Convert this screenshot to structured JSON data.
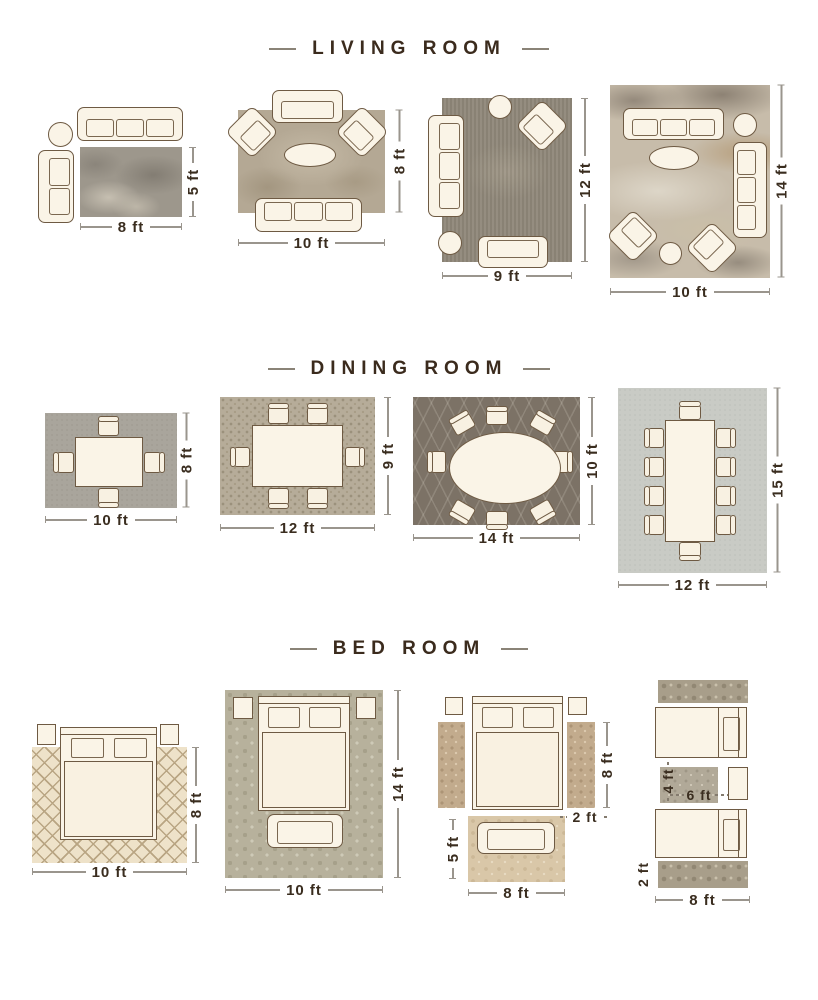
{
  "palette": {
    "background": "#ffffff",
    "title_text": "#3b2b1d",
    "title_dash": "#8a8377",
    "furniture_fill": "#faf4e7",
    "furniture_outline": "#6e5a43",
    "dim_text": "#3a2d1f",
    "dim_line": "#9a958d"
  },
  "living": {
    "title": "LIVING ROOM",
    "dims": {
      "r1w": "8 ft",
      "r1h": "5 ft",
      "r2w": "10 ft",
      "r2h": "8 ft",
      "r3w": "9 ft",
      "r3h": "12 ft",
      "r4w": "10 ft",
      "r4h": "14 ft"
    }
  },
  "dining": {
    "title": "DINING ROOM",
    "dims": {
      "r1w": "10 ft",
      "r1h": "8 ft",
      "r2w": "12 ft",
      "r2h": "9 ft",
      "r3w": "14 ft",
      "r3h": "10 ft",
      "r4w": "12 ft",
      "r4h": "15 ft"
    }
  },
  "bedroom": {
    "title": "BED ROOM",
    "dims": {
      "r1w": "10 ft",
      "r1h": "8 ft",
      "r2w": "10 ft",
      "r2h": "14 ft",
      "r3_runner_h": "8 ft",
      "r3_runner_w": "2 ft",
      "r3_foot_h": "5 ft",
      "r3_foot_w": "8 ft",
      "r4_mid_h": "4 ft",
      "r4_mid_w": "6 ft",
      "r4_runner_h": "2 ft",
      "r4_w": "8 ft"
    }
  }
}
